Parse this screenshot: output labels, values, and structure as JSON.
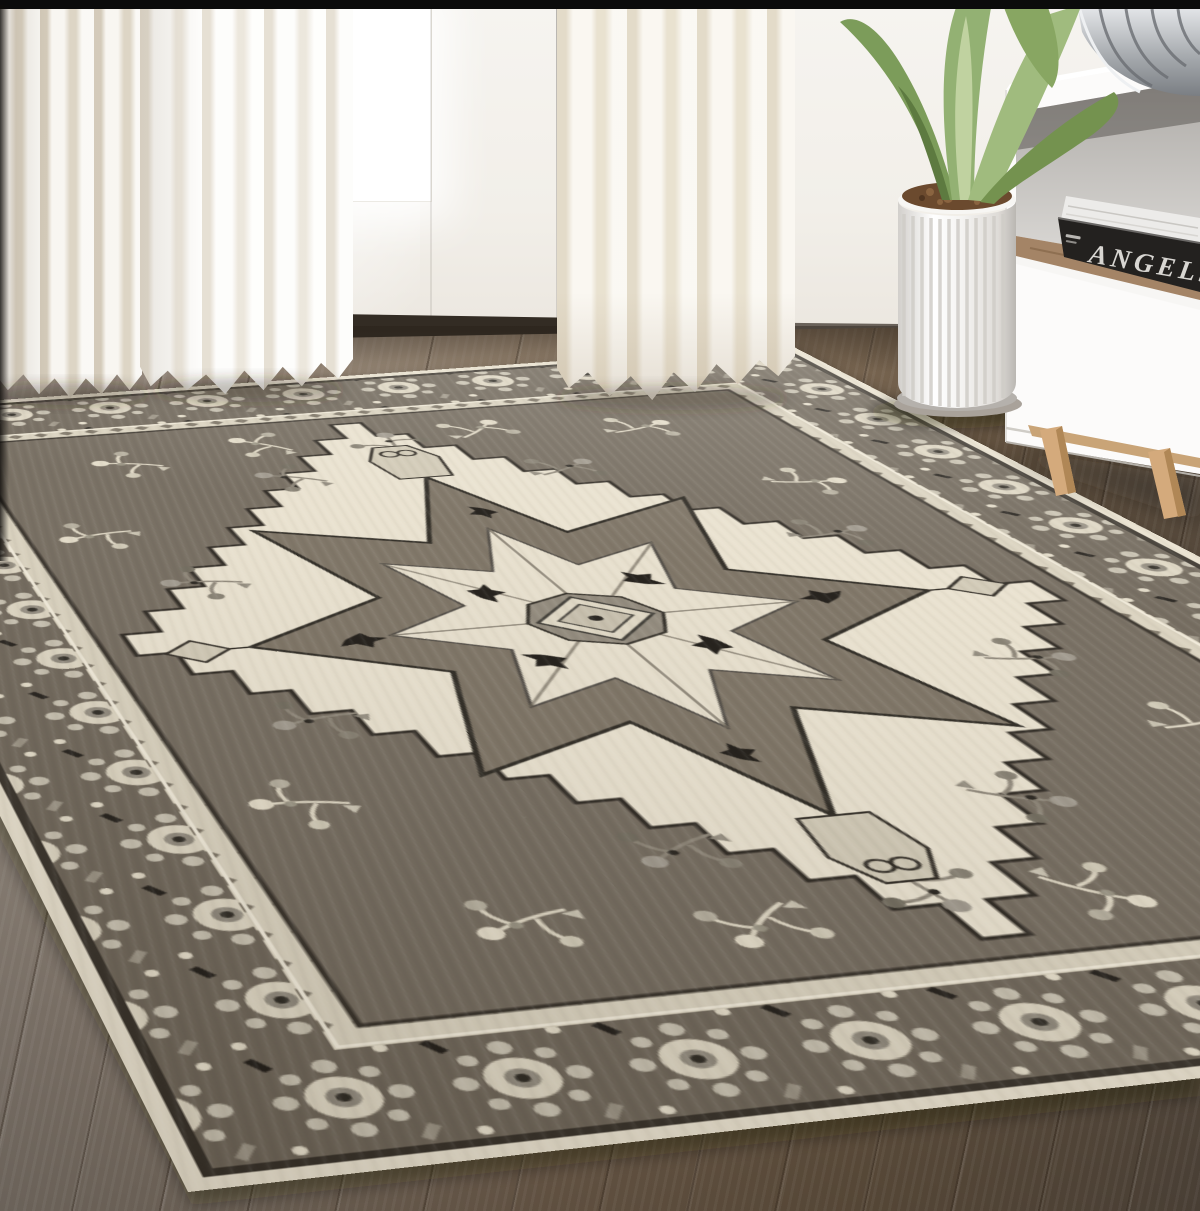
{
  "scene": {
    "type": "lifestyle product photo",
    "subject": "Gray and ivory oriental Heriz-style medallion area rug in a bright living room with sheer curtains, white french doors, dark wood floor, white media cabinet, books, metal bowl and potted agave plant",
    "book_spine_text": "ANGELS",
    "rug_colors": {
      "selvedge_ivory": "#e7dfcc",
      "border_taupe": "#6c6356",
      "field_taupe": "#70675a",
      "panel_ivory": "#e8e0cd",
      "charcoal": "#26221b",
      "warm_gray": "#a49d8e"
    },
    "room_colors": {
      "wall": "#f2efe9",
      "curtain": "#f6f1e8",
      "floor_light": "#958b81",
      "floor_dark": "#50453a",
      "leaf_green": "#93b173",
      "planter_white": "#f4f3f1",
      "wood_leg": "#d4aa7c",
      "bowl_silver": "#c9ccd0",
      "frame_bar": "#0b0b0b"
    }
  }
}
